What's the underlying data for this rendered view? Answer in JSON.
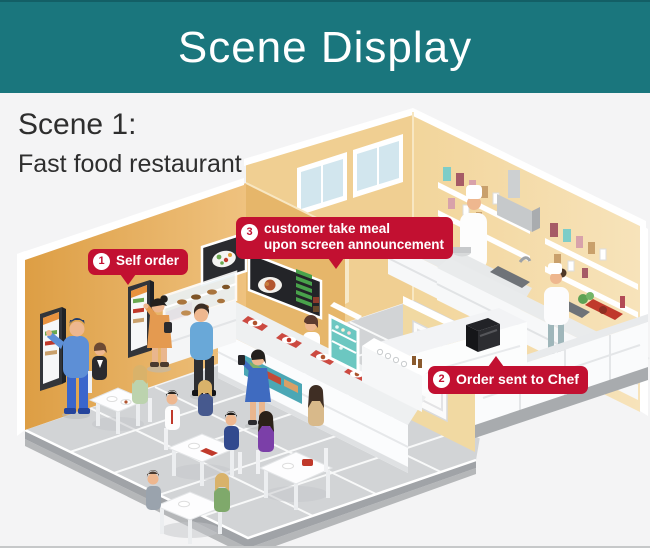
{
  "header": {
    "title": "Scene Display"
  },
  "scene": {
    "title": "Scene 1:",
    "subtitle": "Fast food restaurant"
  },
  "badges": {
    "self_order": {
      "number": "1",
      "label": "Self order"
    },
    "order_sent": {
      "number": "2",
      "label": "Order sent to Chef"
    },
    "take_meal": {
      "number": "3",
      "line1": "customer take meal",
      "line2": "upon screen announcement"
    }
  },
  "colors": {
    "header_teal": "#1a767d",
    "badge_red": "#c21031",
    "wall_ochre": "#e0a44f",
    "wall_tan": "#f0cf92",
    "floor_gray": "#d2d4d6",
    "window_blue": "#d2e6ee",
    "fridge_teal": "#6cc7c1"
  }
}
